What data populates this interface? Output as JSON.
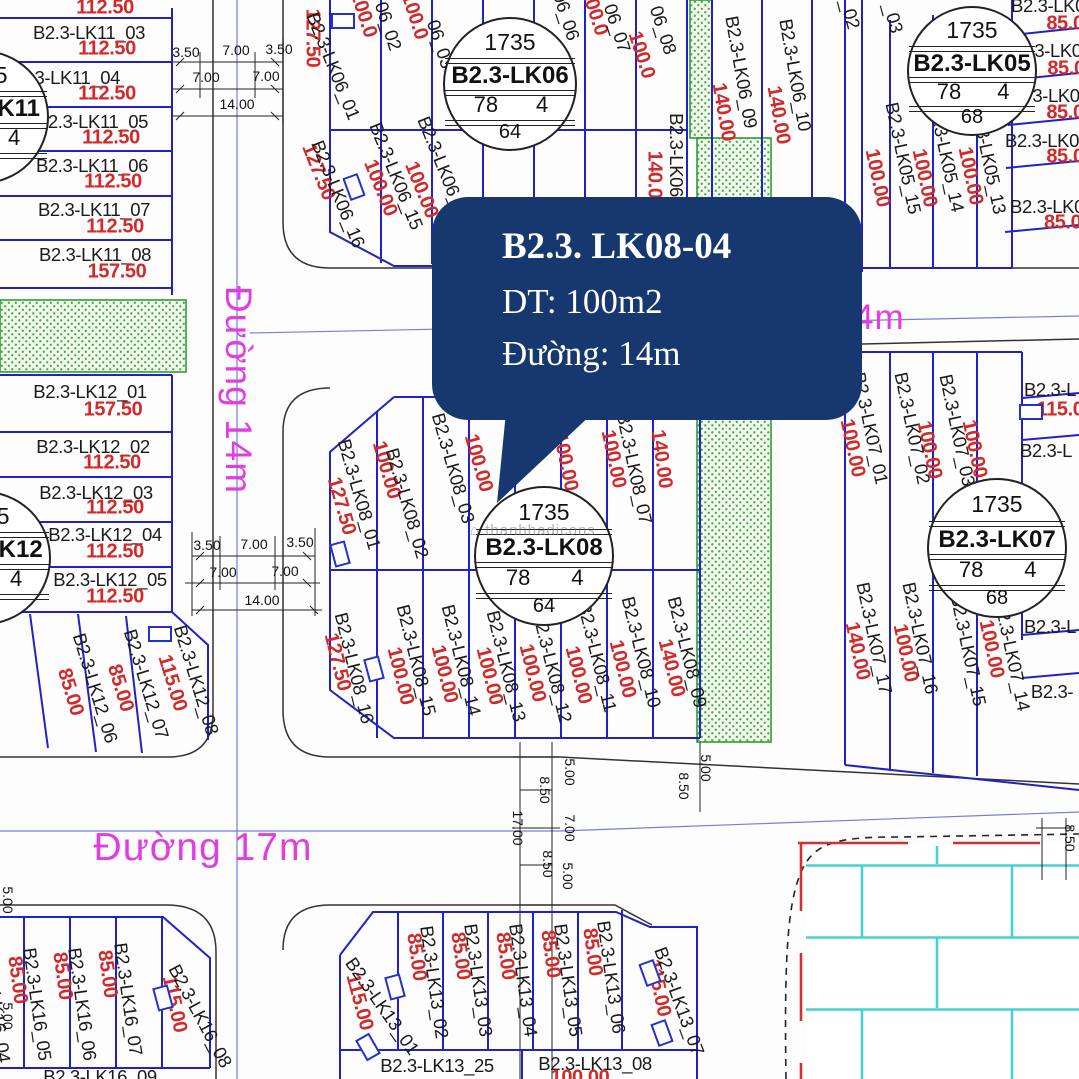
{
  "callout": {
    "title": "B2.3. LK08-04",
    "line2": "DT: 100m2",
    "line3": "Đường: 14m"
  },
  "watermark": {
    "text": "⌂ thanhhadicons"
  },
  "colors": {
    "parcel_blue": "#2121c9",
    "area_red": "#d22a2a",
    "street_magenta": "#e03ee0",
    "callout_navy": "#16386e",
    "green_border": "#2f9e2f",
    "brick_teal": "#46d2d2"
  },
  "markers": [
    {
      "name": "B2.3-LK06",
      "top": "1735",
      "left_num": "78",
      "right_num": "4",
      "bottom": "64",
      "cx": 508,
      "cy": 82,
      "r": 65
    },
    {
      "name": "B2.3-LK05",
      "top": "1735",
      "left_num": "78",
      "right_num": "4",
      "bottom": "68",
      "cx": 970,
      "cy": 69,
      "r": 63
    },
    {
      "name": "B2.3-LK08",
      "top": "1735",
      "left_num": "78",
      "right_num": "4",
      "bottom": "64",
      "cx": 542,
      "cy": 554,
      "r": 68
    },
    {
      "name": "B2.3-LK07",
      "top": "1735",
      "left_num": "78",
      "right_num": "4",
      "bottom": "68",
      "cx": 995,
      "cy": 546,
      "r": 68
    },
    {
      "name": "B2.3-LK11",
      "top": "1735",
      "left_num": "78",
      "right_num": "4",
      "bottom": "64",
      "cx": -20,
      "cy": 115,
      "r": 65
    },
    {
      "name": "B2.3-LK12",
      "top": "1735",
      "left_num": "78",
      "right_num": "4",
      "bottom": "64",
      "cx": -18,
      "cy": 556,
      "r": 65
    }
  ],
  "labels": [
    {
      "t": "112.50",
      "x": 105,
      "y": 8,
      "r": 0,
      "c": "v"
    },
    {
      "t": "B2.3-LK11_03",
      "x": 89,
      "y": 33,
      "r": 0,
      "c": "k"
    },
    {
      "t": "112.50",
      "x": 107,
      "y": 49,
      "r": 0,
      "c": "v"
    },
    {
      "t": "B2.3-LK11_04",
      "x": 64,
      "y": 78,
      "r": 0,
      "c": "k"
    },
    {
      "t": "112.50",
      "x": 107,
      "y": 94,
      "r": 0,
      "c": "v"
    },
    {
      "t": "B2.3-LK11_05",
      "x": 92,
      "y": 122,
      "r": 0,
      "c": "k"
    },
    {
      "t": "112.50",
      "x": 111,
      "y": 138,
      "r": 0,
      "c": "v"
    },
    {
      "t": "B2.3-LK11_06",
      "x": 92,
      "y": 166,
      "r": 0,
      "c": "k"
    },
    {
      "t": "112.50",
      "x": 113,
      "y": 182,
      "r": 0,
      "c": "v"
    },
    {
      "t": "B2.3-LK11_07",
      "x": 94,
      "y": 210,
      "r": 0,
      "c": "k"
    },
    {
      "t": "112.50",
      "x": 115,
      "y": 227,
      "r": 0,
      "c": "v"
    },
    {
      "t": "B2.3-LK11_08",
      "x": 95,
      "y": 255,
      "r": 0,
      "c": "k"
    },
    {
      "t": "157.50",
      "x": 117,
      "y": 272,
      "r": 0,
      "c": "v"
    },
    {
      "t": "B2.3-LK12_01",
      "x": 90,
      "y": 392,
      "r": 0,
      "c": "k"
    },
    {
      "t": "157.50",
      "x": 113,
      "y": 410,
      "r": 0,
      "c": "v"
    },
    {
      "t": "B2.3-LK12_02",
      "x": 93,
      "y": 447,
      "r": 0,
      "c": "k"
    },
    {
      "t": "112.50",
      "x": 112,
      "y": 463,
      "r": 0,
      "c": "v"
    },
    {
      "t": "B2.3-LK12_03",
      "x": 96,
      "y": 493,
      "r": 0,
      "c": "k"
    },
    {
      "t": "112.50",
      "x": 115,
      "y": 508,
      "r": 0,
      "c": "v"
    },
    {
      "t": "B2.3-LK12_04",
      "x": 105,
      "y": 535,
      "r": 0,
      "c": "k"
    },
    {
      "t": "112.50",
      "x": 115,
      "y": 552,
      "r": 0,
      "c": "v"
    },
    {
      "t": "B2.3-LK12_05",
      "x": 110,
      "y": 580,
      "r": 0,
      "c": "k"
    },
    {
      "t": "112.50",
      "x": 115,
      "y": 597,
      "r": 0,
      "c": "v"
    },
    {
      "t": "85.00",
      "x": 70,
      "y": 692,
      "r": 73,
      "c": "v"
    },
    {
      "t": "B2.3-LK12_06",
      "x": 95,
      "y": 688,
      "r": 73,
      "c": "k"
    },
    {
      "t": "85.00",
      "x": 120,
      "y": 688,
      "r": 73,
      "c": "v"
    },
    {
      "t": "B2.3-LK12_07",
      "x": 146,
      "y": 684,
      "r": 73,
      "c": "k"
    },
    {
      "t": "115.00",
      "x": 172,
      "y": 683,
      "r": 73,
      "c": "v"
    },
    {
      "t": "B2.3-LK12_08",
      "x": 196,
      "y": 680,
      "r": 73,
      "c": "k"
    },
    {
      "t": "127.50",
      "x": 312,
      "y": 38,
      "r": 90,
      "c": "v"
    },
    {
      "t": "B2.3-LK06_01",
      "x": 333,
      "y": 66,
      "r": 68,
      "c": "k"
    },
    {
      "t": "100.0",
      "x": 363,
      "y": 14,
      "r": 72,
      "c": "v"
    },
    {
      "t": "06_02",
      "x": 388,
      "y": 26,
      "r": 72,
      "c": "k"
    },
    {
      "t": "100.0",
      "x": 414,
      "y": 16,
      "r": 72,
      "c": "v"
    },
    {
      "t": "06_03",
      "x": 440,
      "y": 44,
      "r": 72,
      "c": "k"
    },
    {
      "t": "06_06",
      "x": 566,
      "y": 16,
      "r": 72,
      "c": "k"
    },
    {
      "t": "100.0",
      "x": 594,
      "y": 12,
      "r": 72,
      "c": "v"
    },
    {
      "t": "06_07",
      "x": 617,
      "y": 28,
      "r": 72,
      "c": "k"
    },
    {
      "t": "100.0",
      "x": 641,
      "y": 55,
      "r": 72,
      "c": "v"
    },
    {
      "t": "06_08",
      "x": 663,
      "y": 30,
      "r": 72,
      "c": "k"
    },
    {
      "t": "B2.3-LK06",
      "x": 676,
      "y": 155,
      "r": 90,
      "c": "k"
    },
    {
      "t": "140.00",
      "x": 654,
      "y": 180,
      "r": 90,
      "c": "v"
    },
    {
      "t": "140.00",
      "x": 723,
      "y": 112,
      "r": 80,
      "c": "v"
    },
    {
      "t": "B2.3-LK06_09",
      "x": 741,
      "y": 72,
      "r": 80,
      "c": "k"
    },
    {
      "t": "140.00",
      "x": 778,
      "y": 115,
      "r": 80,
      "c": "v"
    },
    {
      "t": "B2.3-LK06_10",
      "x": 795,
      "y": 75,
      "r": 80,
      "c": "k"
    },
    {
      "t": "127.50",
      "x": 318,
      "y": 172,
      "r": 68,
      "c": "v"
    },
    {
      "t": "B2.3-LK06_16",
      "x": 338,
      "y": 194,
      "r": 68,
      "c": "k"
    },
    {
      "t": "100.00",
      "x": 380,
      "y": 188,
      "r": 68,
      "c": "v"
    },
    {
      "t": "B2.3-LK06_15",
      "x": 396,
      "y": 176,
      "r": 68,
      "c": "k"
    },
    {
      "t": "100.00",
      "x": 421,
      "y": 190,
      "r": 68,
      "c": "v"
    },
    {
      "t": "B2.3-LK06_14",
      "x": 444,
      "y": 170,
      "r": 68,
      "c": "k"
    },
    {
      "t": "_02",
      "x": 850,
      "y": 14,
      "r": 75,
      "c": "k"
    },
    {
      "t": "_03",
      "x": 893,
      "y": 18,
      "r": 75,
      "c": "k"
    },
    {
      "t": "B2.3-LK05_15",
      "x": 903,
      "y": 158,
      "r": 78,
      "c": "k"
    },
    {
      "t": "100.00",
      "x": 877,
      "y": 178,
      "r": 78,
      "c": "v"
    },
    {
      "t": "B2.3-LK05_14",
      "x": 946,
      "y": 156,
      "r": 78,
      "c": "k"
    },
    {
      "t": "100.00",
      "x": 924,
      "y": 178,
      "r": 78,
      "c": "v"
    },
    {
      "t": "B2.3-LK05_13",
      "x": 988,
      "y": 158,
      "r": 78,
      "c": "k"
    },
    {
      "t": "100.00",
      "x": 970,
      "y": 176,
      "r": 78,
      "c": "v"
    },
    {
      "t": "B2.3-LK0",
      "x": 1048,
      "y": 6,
      "r": 0,
      "c": "k"
    },
    {
      "t": "85.0",
      "x": 1065,
      "y": 24,
      "r": 0,
      "c": "v"
    },
    {
      "t": "3-LK0",
      "x": 1058,
      "y": 51,
      "r": 0,
      "c": "k"
    },
    {
      "t": "85.0",
      "x": 1066,
      "y": 69,
      "r": 0,
      "c": "v"
    },
    {
      "t": "3-LK0",
      "x": 1056,
      "y": 96,
      "r": 0,
      "c": "k"
    },
    {
      "t": "85.0",
      "x": 1065,
      "y": 113,
      "r": 0,
      "c": "v"
    },
    {
      "t": "B2.3-LK0",
      "x": 1042,
      "y": 141,
      "r": 0,
      "c": "k"
    },
    {
      "t": "85.0",
      "x": 1065,
      "y": 157,
      "r": 0,
      "c": "v"
    },
    {
      "t": "B2.3-LK0",
      "x": 1047,
      "y": 207,
      "r": 0,
      "c": "k"
    },
    {
      "t": "85.00",
      "x": 1068,
      "y": 223,
      "r": 0,
      "c": "v"
    },
    {
      "t": "127.50",
      "x": 341,
      "y": 506,
      "r": 74,
      "c": "v"
    },
    {
      "t": "B2.3-LK08_01",
      "x": 359,
      "y": 494,
      "r": 74,
      "c": "k"
    },
    {
      "t": "100.00",
      "x": 386,
      "y": 470,
      "r": 74,
      "c": "v"
    },
    {
      "t": "B2.3-LK08_02",
      "x": 407,
      "y": 503,
      "r": 74,
      "c": "k"
    },
    {
      "t": "100.00",
      "x": 478,
      "y": 463,
      "r": 74,
      "c": "v"
    },
    {
      "t": "B2.3-LK08_03",
      "x": 453,
      "y": 468,
      "r": 74,
      "c": "k"
    },
    {
      "t": "100.00",
      "x": 565,
      "y": 462,
      "r": 78,
      "c": "v"
    },
    {
      "t": "100.00",
      "x": 613,
      "y": 459,
      "r": 78,
      "c": "v"
    },
    {
      "t": "B2.3-LK08_07",
      "x": 634,
      "y": 468,
      "r": 78,
      "c": "k"
    },
    {
      "t": "140.00",
      "x": 661,
      "y": 459,
      "r": 82,
      "c": "v"
    },
    {
      "t": "127.50",
      "x": 337,
      "y": 662,
      "r": 76,
      "c": "v"
    },
    {
      "t": "B2.3-LK08_16",
      "x": 354,
      "y": 668,
      "r": 76,
      "c": "k"
    },
    {
      "t": "100.00",
      "x": 400,
      "y": 676,
      "r": 76,
      "c": "v"
    },
    {
      "t": "B2.3-LK08_15",
      "x": 416,
      "y": 660,
      "r": 76,
      "c": "k"
    },
    {
      "t": "100.00",
      "x": 444,
      "y": 674,
      "r": 76,
      "c": "v"
    },
    {
      "t": "B2.3-LK08_14",
      "x": 461,
      "y": 660,
      "r": 76,
      "c": "k"
    },
    {
      "t": "100.00",
      "x": 489,
      "y": 676,
      "r": 76,
      "c": "v"
    },
    {
      "t": "B2.3-LK08_13",
      "x": 506,
      "y": 666,
      "r": 76,
      "c": "k"
    },
    {
      "t": "100.00",
      "x": 532,
      "y": 673,
      "r": 76,
      "c": "v"
    },
    {
      "t": "B2.3-LK08_12",
      "x": 552,
      "y": 667,
      "r": 76,
      "c": "k"
    },
    {
      "t": "100.00",
      "x": 578,
      "y": 675,
      "r": 76,
      "c": "v"
    },
    {
      "t": "B2.3-LK08_11",
      "x": 597,
      "y": 657,
      "r": 76,
      "c": "k"
    },
    {
      "t": "100.00",
      "x": 622,
      "y": 669,
      "r": 76,
      "c": "v"
    },
    {
      "t": "B2.3-LK08_10",
      "x": 641,
      "y": 652,
      "r": 76,
      "c": "k"
    },
    {
      "t": "140.00",
      "x": 671,
      "y": 668,
      "r": 76,
      "c": "v"
    },
    {
      "t": "B2.3-LK08_09",
      "x": 687,
      "y": 652,
      "r": 76,
      "c": "k"
    },
    {
      "t": "100.00",
      "x": 852,
      "y": 448,
      "r": 78,
      "c": "v"
    },
    {
      "t": "B2.3-LK07_01",
      "x": 870,
      "y": 428,
      "r": 78,
      "c": "k"
    },
    {
      "t": "100.00",
      "x": 929,
      "y": 450,
      "r": 78,
      "c": "v"
    },
    {
      "t": "B2.3-LK07_02",
      "x": 912,
      "y": 428,
      "r": 78,
      "c": "k"
    },
    {
      "t": "100.00",
      "x": 974,
      "y": 449,
      "r": 78,
      "c": "v"
    },
    {
      "t": "B2.3-LK07_03",
      "x": 957,
      "y": 430,
      "r": 78,
      "c": "k"
    },
    {
      "t": "B2.3-L",
      "x": 1050,
      "y": 390,
      "r": 0,
      "c": "k"
    },
    {
      "t": "115.0",
      "x": 1060,
      "y": 410,
      "r": 0,
      "c": "v"
    },
    {
      "t": "B2.3-L",
      "x": 1046,
      "y": 451,
      "r": 0,
      "c": "k"
    },
    {
      "t": "140.00",
      "x": 857,
      "y": 651,
      "r": 78,
      "c": "v"
    },
    {
      "t": "B2.3-LK07_17",
      "x": 874,
      "y": 638,
      "r": 78,
      "c": "k"
    },
    {
      "t": "100.00",
      "x": 905,
      "y": 653,
      "r": 78,
      "c": "v"
    },
    {
      "t": "B2.3-LK07_16",
      "x": 920,
      "y": 638,
      "r": 78,
      "c": "k"
    },
    {
      "t": "100.00",
      "x": 991,
      "y": 649,
      "r": 78,
      "c": "v"
    },
    {
      "t": "B2.3-LK07_15",
      "x": 968,
      "y": 650,
      "r": 78,
      "c": "k"
    },
    {
      "t": "B2.3-LK07_14",
      "x": 1012,
      "y": 655,
      "r": 78,
      "c": "k"
    },
    {
      "t": "B2.3-L",
      "x": 1050,
      "y": 627,
      "r": 0,
      "c": "k"
    },
    {
      "t": "B2.3-",
      "x": 1052,
      "y": 692,
      "r": 0,
      "c": "k"
    },
    {
      "t": "B2.3-LK16_04",
      "x": -4,
      "y": 1006,
      "r": 82,
      "c": "k"
    },
    {
      "t": "85.00",
      "x": 17,
      "y": 980,
      "r": 82,
      "c": "v"
    },
    {
      "t": "B2.3-LK16_05",
      "x": 37,
      "y": 1004,
      "r": 82,
      "c": "k"
    },
    {
      "t": "85.00",
      "x": 62,
      "y": 976,
      "r": 82,
      "c": "v"
    },
    {
      "t": "B2.3-LK16_06",
      "x": 82,
      "y": 1004,
      "r": 82,
      "c": "k"
    },
    {
      "t": "85.00",
      "x": 107,
      "y": 974,
      "r": 82,
      "c": "v"
    },
    {
      "t": "B2.3-LK16_07",
      "x": 128,
      "y": 999,
      "r": 82,
      "c": "k"
    },
    {
      "t": "115.00",
      "x": 174,
      "y": 1004,
      "r": 78,
      "c": "v"
    },
    {
      "t": "B2.3-LK16_08",
      "x": 200,
      "y": 1016,
      "r": 62,
      "c": "k"
    },
    {
      "t": "B2.3-LK16_09",
      "x": 100,
      "y": 1077,
      "r": 0,
      "c": "k"
    },
    {
      "t": "115.00",
      "x": 359,
      "y": 1002,
      "r": 75,
      "c": "v"
    },
    {
      "t": "B2.3-LK13_01",
      "x": 382,
      "y": 1006,
      "r": 55,
      "c": "k"
    },
    {
      "t": "85.00",
      "x": 416,
      "y": 957,
      "r": 82,
      "c": "v"
    },
    {
      "t": "B2.3-LK13_02",
      "x": 434,
      "y": 982,
      "r": 82,
      "c": "k"
    },
    {
      "t": "85.00",
      "x": 460,
      "y": 956,
      "r": 82,
      "c": "v"
    },
    {
      "t": "B2.3-LK13_03",
      "x": 478,
      "y": 980,
      "r": 82,
      "c": "k"
    },
    {
      "t": "85.00",
      "x": 505,
      "y": 956,
      "r": 82,
      "c": "v"
    },
    {
      "t": "B2.3-LK13_04",
      "x": 523,
      "y": 980,
      "r": 82,
      "c": "k"
    },
    {
      "t": "85.00",
      "x": 550,
      "y": 954,
      "r": 82,
      "c": "v"
    },
    {
      "t": "B2.3-LK13_05",
      "x": 568,
      "y": 980,
      "r": 82,
      "c": "k"
    },
    {
      "t": "85.00",
      "x": 592,
      "y": 952,
      "r": 82,
      "c": "v"
    },
    {
      "t": "B2.3-LK13_06",
      "x": 611,
      "y": 977,
      "r": 82,
      "c": "k"
    },
    {
      "t": "115.00",
      "x": 658,
      "y": 988,
      "r": 78,
      "c": "v"
    },
    {
      "t": "B2.3-LK13_07",
      "x": 679,
      "y": 1001,
      "r": 70,
      "c": "k"
    },
    {
      "t": "B2.3-LK13_25",
      "x": 437,
      "y": 1066,
      "r": 0,
      "c": "k"
    },
    {
      "t": "B2.3-LK13_08",
      "x": 595,
      "y": 1064,
      "r": 0,
      "c": "k"
    },
    {
      "t": "100.00",
      "x": 580,
      "y": 1078,
      "r": 0,
      "c": "v"
    }
  ],
  "street_labels": [
    {
      "t": "Đường 14m",
      "x": 238,
      "y": 390,
      "r": 90,
      "fs": 37
    },
    {
      "t": "Đường 17m",
      "x": 203,
      "y": 848,
      "r": 0,
      "fs": 39
    },
    {
      "t": "Đường 14m",
      "x": 806,
      "y": 318,
      "r": 0,
      "fs": 35
    }
  ],
  "dim_labels": [
    {
      "t": "3.50",
      "x": 186,
      "y": 52,
      "r": 0
    },
    {
      "t": "7.00",
      "x": 236,
      "y": 50,
      "r": 0
    },
    {
      "t": "3.50",
      "x": 279,
      "y": 49,
      "r": 0
    },
    {
      "t": "7.00",
      "x": 206,
      "y": 77,
      "r": 0
    },
    {
      "t": "7.00",
      "x": 266,
      "y": 76,
      "r": 0
    },
    {
      "t": "14.00",
      "x": 237,
      "y": 104,
      "r": 0
    },
    {
      "t": "3.50",
      "x": 207,
      "y": 545,
      "r": 0
    },
    {
      "t": "7.00",
      "x": 254,
      "y": 544,
      "r": 0
    },
    {
      "t": "3.50",
      "x": 300,
      "y": 542,
      "r": 0
    },
    {
      "t": "7.00",
      "x": 223,
      "y": 572,
      "r": 0
    },
    {
      "t": "7.00",
      "x": 285,
      "y": 571,
      "r": 0
    },
    {
      "t": "14.00",
      "x": 262,
      "y": 600,
      "r": 0
    },
    {
      "t": "5.00",
      "x": 570,
      "y": 772,
      "r": 90
    },
    {
      "t": "8.50",
      "x": 545,
      "y": 790,
      "r": 90
    },
    {
      "t": "17.00",
      "x": 518,
      "y": 828,
      "r": 90
    },
    {
      "t": "7.00",
      "x": 570,
      "y": 828,
      "r": 90
    },
    {
      "t": "8.50",
      "x": 548,
      "y": 864,
      "r": 90
    },
    {
      "t": "5.00",
      "x": 568,
      "y": 876,
      "r": 90
    },
    {
      "t": "5.00",
      "x": 706,
      "y": 768,
      "r": 90
    },
    {
      "t": "8.50",
      "x": 684,
      "y": 786,
      "r": 90
    },
    {
      "t": "5.00",
      "x": 8,
      "y": 900,
      "r": 90
    },
    {
      "t": "5.00",
      "x": 8,
      "y": 1016,
      "r": 90
    },
    {
      "t": "8.50",
      "x": 1070,
      "y": 838,
      "r": 90
    }
  ],
  "door_icons": [
    {
      "x": 341,
      "y": 19,
      "r": 0
    },
    {
      "x": 352,
      "y": 185,
      "r": 70
    },
    {
      "x": 158,
      "y": 632,
      "r": 0
    },
    {
      "x": 372,
      "y": 667,
      "r": 75
    },
    {
      "x": 338,
      "y": 552,
      "r": 75
    },
    {
      "x": 1029,
      "y": 410,
      "r": 0
    },
    {
      "x": 161,
      "y": 996,
      "r": 75
    },
    {
      "x": 366,
      "y": 1045,
      "r": 60
    },
    {
      "x": 393,
      "y": 985,
      "r": 75
    },
    {
      "x": 648,
      "y": 971,
      "r": 70
    },
    {
      "x": 660,
      "y": 1031,
      "r": 70
    }
  ]
}
